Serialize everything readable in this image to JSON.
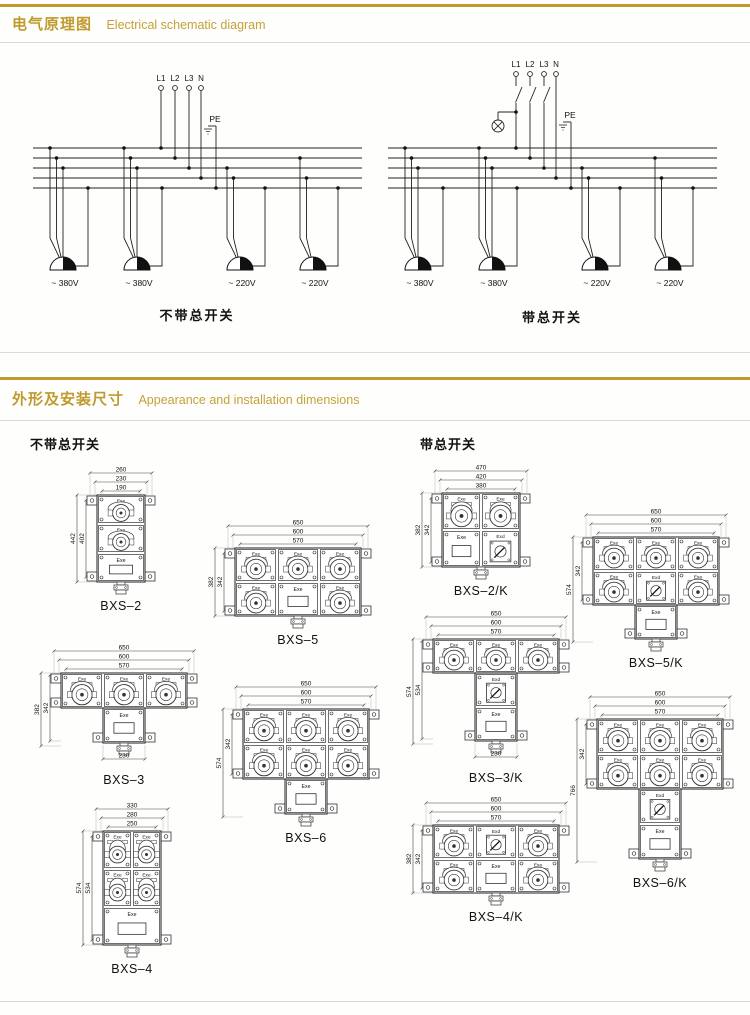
{
  "accent_color": "#c09a2e",
  "line_color": "#222222",
  "sections": {
    "schematic": {
      "title_zh": "电气原理图",
      "title_en": "Electrical schematic diagram",
      "terminals": [
        "L1",
        "L2",
        "L3",
        "N"
      ],
      "pe_label": "PE",
      "diagrams": [
        {
          "id": "without-main-switch",
          "caption": "不带总开关",
          "has_main_switch": false,
          "outlets": [
            "~ 380V",
            "~ 380V",
            "~ 220V",
            "~ 220V"
          ]
        },
        {
          "id": "with-main-switch",
          "caption": "带总开关",
          "has_main_switch": true,
          "outlets": [
            "~ 380V",
            "~ 380V",
            "~ 220V",
            "~ 220V"
          ]
        }
      ]
    },
    "dimensions": {
      "title_zh": "外形及安装尺寸",
      "title_en": "Appearance and installation dimensions",
      "col_left_header": "不带总开关",
      "col_right_header": "带总开关",
      "cell_labels": {
        "socket": "Exe",
        "panel": "Exe",
        "switch": "Exd"
      },
      "units": [
        {
          "id": "bxs2",
          "label": "BXS–2",
          "top_dims": [
            "260",
            "230",
            "190"
          ],
          "left_dims": [
            "442",
            "402"
          ],
          "left_ext": [
            "all",
            "grid"
          ],
          "grid": [
            [
              "socket"
            ],
            [
              "socket"
            ],
            [
              "panel"
            ]
          ],
          "tail": [],
          "bottom_dim": null,
          "cw": 48,
          "ch": 29
        },
        {
          "id": "bxs5",
          "label": "BXS–5",
          "top_dims": [
            "650",
            "600",
            "570"
          ],
          "left_dims": [
            "382",
            "342"
          ],
          "left_ext": [
            "all",
            "grid"
          ],
          "grid": [
            [
              "socket",
              "socket",
              "socket"
            ],
            [
              "socket",
              "panel",
              "socket"
            ]
          ],
          "tail": [],
          "bottom_dim": null,
          "cw": 42,
          "ch": 34
        },
        {
          "id": "bxs3",
          "label": "BXS–3",
          "top_dims": [
            "650",
            "600",
            "570"
          ],
          "left_dims": [
            "382",
            "342"
          ],
          "left_ext": [
            "all",
            "mid"
          ],
          "grid": [
            [
              "socket",
              "socket",
              "socket"
            ]
          ],
          "tail": [
            "panel"
          ],
          "bottom_dim": "230",
          "cw": 42,
          "ch": 35
        },
        {
          "id": "bxs6",
          "label": "BXS–6",
          "top_dims": [
            "650",
            "600",
            "570"
          ],
          "left_dims": [
            "574",
            "342"
          ],
          "left_ext": [
            "all",
            "grid"
          ],
          "grid": [
            [
              "socket",
              "socket",
              "socket"
            ],
            [
              "socket",
              "socket",
              "socket"
            ]
          ],
          "tail": [
            "panel"
          ],
          "bottom_dim": null,
          "cw": 42,
          "ch": 35
        },
        {
          "id": "bxs4",
          "label": "BXS–4",
          "top_dims": [
            "330",
            "280",
            "250"
          ],
          "left_dims": [
            "574",
            "534"
          ],
          "left_ext": [
            "all",
            "grid"
          ],
          "grid": [
            [
              "socket",
              "socket"
            ],
            [
              "socket",
              "socket"
            ],
            [
              "panel:2"
            ]
          ],
          "tail": [],
          "bottom_dim": null,
          "cw": 29,
          "ch": 38
        },
        {
          "id": "bxs2k",
          "label": "BXS–2/K",
          "top_dims": [
            "470",
            "420",
            "380"
          ],
          "left_dims": [
            "382",
            "342"
          ],
          "left_ext": [
            "all",
            "grid"
          ],
          "grid": [
            [
              "socket",
              "socket"
            ],
            [
              "panel",
              "switch"
            ]
          ],
          "tail": [],
          "bottom_dim": null,
          "cw": 39,
          "ch": 37
        },
        {
          "id": "bxs5k",
          "label": "BXS–5/K",
          "top_dims": [
            "650",
            "600",
            "570"
          ],
          "left_dims": [
            "574",
            "342"
          ],
          "left_ext": [
            "all",
            "grid"
          ],
          "grid": [
            [
              "socket",
              "socket",
              "socket"
            ],
            [
              "socket",
              "switch",
              "socket"
            ]
          ],
          "tail": [
            "panel"
          ],
          "bottom_dim": null,
          "cw": 42,
          "ch": 34
        },
        {
          "id": "bxs3k",
          "label": "BXS–3/K",
          "top_dims": [
            "650",
            "600",
            "570"
          ],
          "left_dims": [
            "574",
            "534"
          ],
          "left_ext": [
            "all",
            "mid"
          ],
          "grid": [
            [
              "socket",
              "socket",
              "socket"
            ]
          ],
          "tail": [
            "switch",
            "panel"
          ],
          "bottom_dim": "230",
          "cw": 42,
          "ch": 34
        },
        {
          "id": "bxs6k",
          "label": "BXS–6/K",
          "top_dims": [
            "650",
            "600",
            "570"
          ],
          "left_dims": [
            "766",
            "342"
          ],
          "left_ext": [
            "all",
            "grid"
          ],
          "grid": [
            [
              "socket",
              "socket",
              "socket"
            ],
            [
              "socket",
              "socket",
              "socket"
            ]
          ],
          "tail": [
            "switch",
            "panel"
          ],
          "bottom_dim": null,
          "cw": 42,
          "ch": 35
        },
        {
          "id": "bxs4k",
          "label": "BXS–4/K",
          "top_dims": [
            "650",
            "600",
            "570"
          ],
          "left_dims": [
            "382",
            "342"
          ],
          "left_ext": [
            "all",
            "grid"
          ],
          "grid": [
            [
              "socket",
              "switch",
              "socket"
            ],
            [
              "socket",
              "panel",
              "socket"
            ]
          ],
          "tail": [],
          "bottom_dim": null,
          "cw": 42,
          "ch": 34
        }
      ]
    }
  }
}
